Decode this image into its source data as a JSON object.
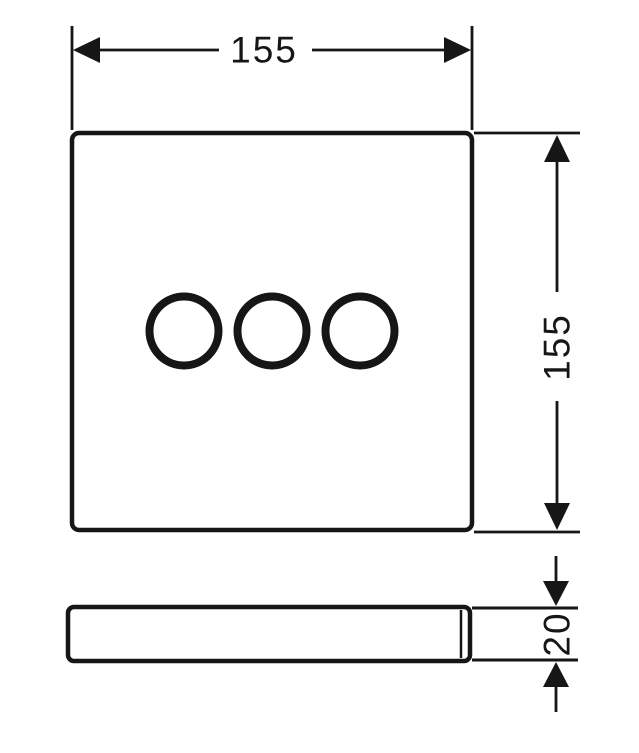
{
  "drawing": {
    "background_color": "#ffffff",
    "line_color": "#161616",
    "views": {
      "front": "front-view-square-plate-with-three-circles",
      "side": "side-view-plate-profile"
    },
    "labels": {
      "width": "155",
      "height": "155",
      "depth": "20"
    }
  }
}
